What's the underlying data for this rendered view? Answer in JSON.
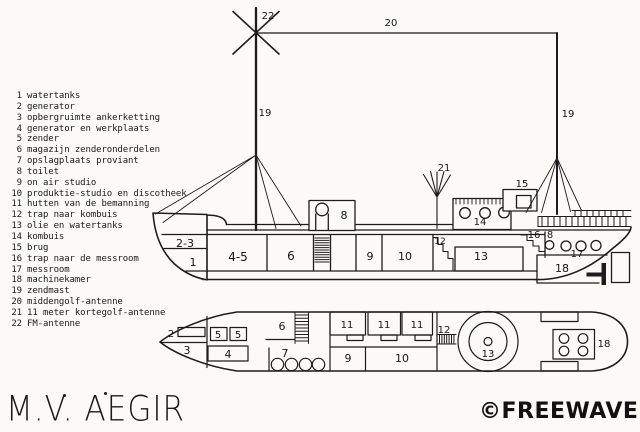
{
  "colors": {
    "ink": "#1a1a1a",
    "paper": "#fbfaf7"
  },
  "legend": {
    "items": [
      {
        "n": "1",
        "label": "watertanks"
      },
      {
        "n": "2",
        "label": "generator"
      },
      {
        "n": "3",
        "label": "opbergruimte ankerketting"
      },
      {
        "n": "4",
        "label": "generator en werkplaats"
      },
      {
        "n": "5",
        "label": "zender"
      },
      {
        "n": "6",
        "label": "magazijn zenderonderdelen"
      },
      {
        "n": "7",
        "label": "opslagplaats proviant"
      },
      {
        "n": "8",
        "label": "toilet"
      },
      {
        "n": "9",
        "label": "on air studio"
      },
      {
        "n": "10",
        "label": "produktie-studio en discotheek"
      },
      {
        "n": "11",
        "label": "hutten van de bemanning"
      },
      {
        "n": "12",
        "label": "trap naar kombuis"
      },
      {
        "n": "13",
        "label": "olie en watertanks"
      },
      {
        "n": "14",
        "label": "kombuis"
      },
      {
        "n": "15",
        "label": "brug"
      },
      {
        "n": "16",
        "label": "trap naar de messroom"
      },
      {
        "n": "17",
        "label": "messroom"
      },
      {
        "n": "18",
        "label": "machinekamer"
      },
      {
        "n": "19",
        "label": "zendmast"
      },
      {
        "n": "20",
        "label": "middengolf-antenne"
      },
      {
        "n": "21",
        "label": "11 meter kortegolf-antenne"
      },
      {
        "n": "22",
        "label": "FM-antenne"
      }
    ]
  },
  "side_view": {
    "labels": [
      {
        "t": "22",
        "x": 268,
        "y": 19,
        "s": 10
      },
      {
        "t": "20",
        "x": 391,
        "y": 26,
        "s": 10
      },
      {
        "t": "19",
        "x": 265,
        "y": 116,
        "s": 10
      },
      {
        "t": "19",
        "x": 568,
        "y": 117,
        "s": 10
      },
      {
        "t": "21",
        "x": 444,
        "y": 171,
        "s": 10
      },
      {
        "t": "15",
        "x": 522,
        "y": 187,
        "s": 10
      },
      {
        "t": "8",
        "x": 344,
        "y": 219,
        "s": 11
      },
      {
        "t": "14",
        "x": 480,
        "y": 225,
        "s": 10
      },
      {
        "t": "2-3",
        "x": 185,
        "y": 247,
        "s": 11
      },
      {
        "t": "1",
        "x": 193,
        "y": 266,
        "s": 11
      },
      {
        "t": "4-5",
        "x": 238,
        "y": 261,
        "s": 12
      },
      {
        "t": "6",
        "x": 291,
        "y": 260,
        "s": 12
      },
      {
        "t": "9",
        "x": 370,
        "y": 260,
        "s": 11
      },
      {
        "t": "10",
        "x": 405,
        "y": 260,
        "s": 11
      },
      {
        "t": "12",
        "x": 440,
        "y": 244,
        "s": 9
      },
      {
        "t": "13",
        "x": 481,
        "y": 260,
        "s": 11
      },
      {
        "t": "16",
        "x": 534,
        "y": 238,
        "s": 10
      },
      {
        "t": "8",
        "x": 550,
        "y": 238,
        "s": 10
      },
      {
        "t": "17",
        "x": 577,
        "y": 257,
        "s": 10
      },
      {
        "t": "18",
        "x": 562,
        "y": 272,
        "s": 11
      }
    ]
  },
  "top_view": {
    "labels": [
      {
        "t": "2",
        "x": 171,
        "y": 337,
        "s": 10
      },
      {
        "t": "3",
        "x": 187,
        "y": 354,
        "s": 11
      },
      {
        "t": "5",
        "x": 218,
        "y": 338,
        "s": 10
      },
      {
        "t": "5",
        "x": 238,
        "y": 338,
        "s": 10
      },
      {
        "t": "4",
        "x": 228,
        "y": 358,
        "s": 11
      },
      {
        "t": "6",
        "x": 282,
        "y": 330,
        "s": 11
      },
      {
        "t": "7",
        "x": 285,
        "y": 357,
        "s": 11
      },
      {
        "t": "11",
        "x": 347,
        "y": 328,
        "s": 10
      },
      {
        "t": "11",
        "x": 384,
        "y": 328,
        "s": 10
      },
      {
        "t": "11",
        "x": 417,
        "y": 328,
        "s": 10
      },
      {
        "t": "9",
        "x": 348,
        "y": 362,
        "s": 11
      },
      {
        "t": "10",
        "x": 402,
        "y": 362,
        "s": 11
      },
      {
        "t": "12",
        "x": 444,
        "y": 333,
        "s": 10
      },
      {
        "t": "13",
        "x": 488,
        "y": 357,
        "s": 10
      },
      {
        "t": "18",
        "x": 604,
        "y": 347,
        "s": 10
      }
    ]
  },
  "footer": {
    "vessel_name": "M.V. AEGIR",
    "credit": "©FREEWAVE"
  }
}
